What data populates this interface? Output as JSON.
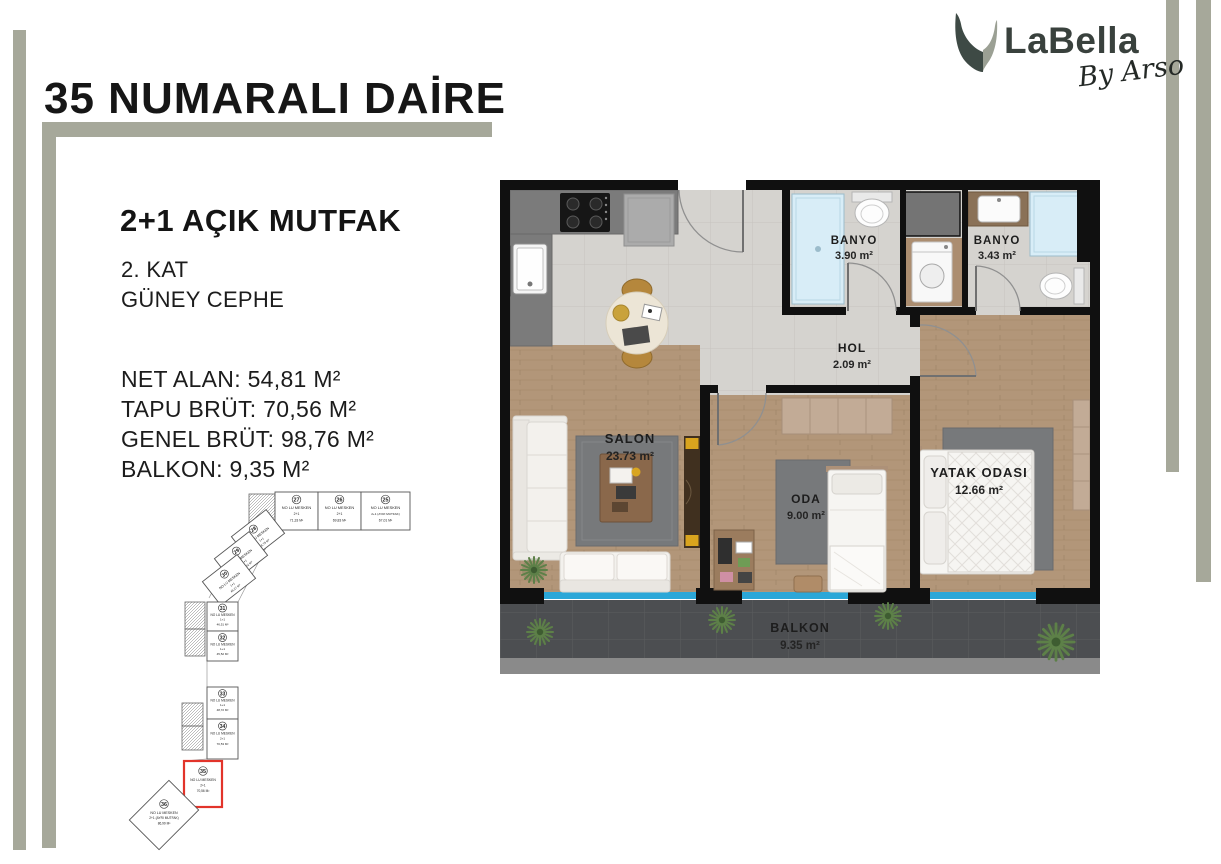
{
  "page": {
    "title": "35 NUMARALI DAİRE"
  },
  "logo": {
    "brand": "LaBella",
    "tagline": "By Arso"
  },
  "info": {
    "type": "2+1 AÇIK MUTFAK",
    "floor": "2. KAT",
    "facade": "GÜNEY CEPHE",
    "net_alan": "NET ALAN: 54,81 M²",
    "tapu_brut": "TAPU BRÜT: 70,56 M²",
    "genel_brut": "GENEL BRÜT: 98,76 M²",
    "balkon": "BALKON: 9,35 M²"
  },
  "plan": {
    "rooms": [
      {
        "name": "SALON",
        "area": "23.73 m²"
      },
      {
        "name": "ODA",
        "area": "9.00 m²"
      },
      {
        "name": "YATAK ODASI",
        "area": "12.66 m²"
      },
      {
        "name": "BANYO",
        "area": "3.90 m²"
      },
      {
        "name": "BANYO",
        "area": "3.43 m²"
      },
      {
        "name": "HOL",
        "area": "2.09 m²"
      },
      {
        "name": "BALKON",
        "area": "9.35 m²"
      }
    ]
  },
  "siteplan": {
    "highlighted_unit": "35",
    "units": [
      {
        "number": "27",
        "name": "NO LU MESKEN",
        "type": "2+1",
        "area": "71,33 M²"
      },
      {
        "number": "26",
        "name": "NO LU MESKEN",
        "type": "2+1",
        "area": "69,83 M²"
      },
      {
        "number": "25",
        "name": "NO LU MESKEN",
        "type": "2+1 (AYRI MUTFAK)",
        "area": "67,01 M²"
      },
      {
        "number": "28",
        "name": "NO LU MESKEN",
        "type": "1+1",
        "area": "48,78 M²"
      },
      {
        "number": "29",
        "name": "NO LU MESKEN",
        "type": "1+1",
        "area": "47,52 M²"
      },
      {
        "number": "30",
        "name": "NO LU MESKEN",
        "type": "1+1",
        "area": "45,27 M²"
      },
      {
        "number": "31",
        "name": "NO LU MESKEN",
        "type": "1+1",
        "area": "46,51 M²"
      },
      {
        "number": "32",
        "name": "NO LU MESKEN",
        "type": "1+1",
        "area": "45,52 M²"
      },
      {
        "number": "33",
        "name": "NO LU MESKEN",
        "type": "1+1",
        "area": "48,72 M²"
      },
      {
        "number": "34",
        "name": "NO LU MESKEN",
        "type": "2+1",
        "area": "70,53 M²"
      },
      {
        "number": "35",
        "name": "NO LU MESKEN",
        "type": "2+1",
        "area": "70,56 M²"
      },
      {
        "number": "36",
        "name": "NO LU MESKEN",
        "type": "2+1 (AYRI MUTFAK)",
        "area": "86,99 M²"
      }
    ]
  },
  "colors": {
    "accent_bar": "#a6a89a",
    "wall": "#101010",
    "wood_floor": "#b29679",
    "tile_floor": "#d5d3cf",
    "balcony_floor": "#4c4e51",
    "railing_glass": "#2ba7d8",
    "highlight_red": "#e2342a"
  }
}
